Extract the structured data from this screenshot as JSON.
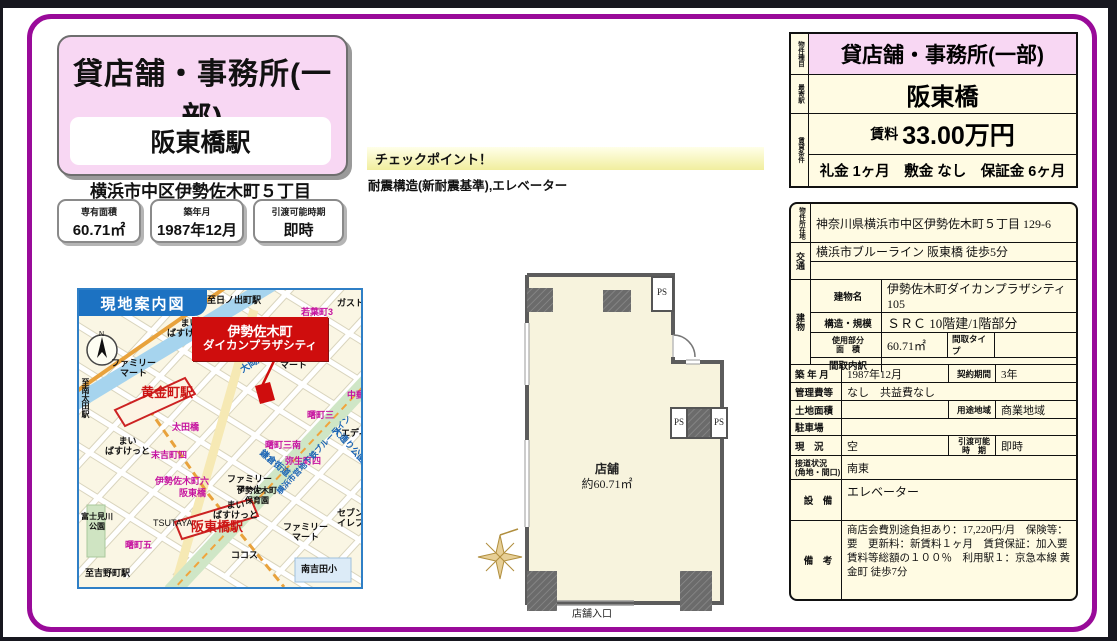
{
  "left": {
    "property_type": "貸店舗・事務所(一部)",
    "station": "阪東橋駅",
    "address": "横浜市中区伊勢佐木町５丁目",
    "stats": [
      {
        "label": "専有面積",
        "value": "60.71㎡"
      },
      {
        "label": "築年月",
        "value": "1987年12月"
      },
      {
        "label": "引渡可能時期",
        "value": "即時"
      }
    ]
  },
  "checkpoint": {
    "title": "チェックポイント！",
    "text": "耐震構造(新耐震基準),エレベーター"
  },
  "summary": {
    "type_label": "物件種目",
    "type_value": "貸店舗・事務所(一部)",
    "station_label": "最寄駅",
    "station_value": "阪東橋",
    "terms_label": "賃貸条件",
    "rent_label": "賃料",
    "rent_value": "33.00万円",
    "terms_value": "礼金 1ヶ月　敷金 なし　保証金 6ヶ月"
  },
  "details": {
    "location_label": "物件所在地",
    "location_value": "神奈川県横浜市中区伊勢佐木町５丁目 129-6",
    "access_label": "交通",
    "access_value": "横浜市ブルーライン 阪東橋 徒歩5分",
    "building_label": "建物",
    "building_name_label": "建物名",
    "building_name_value": "伊勢佐木町ダイカンプラザシティ　105",
    "structure_label": "構造・規模",
    "structure_value": "ＳＲＣ 10階建/1階部分",
    "used_area_label": "使用部分\n面　積",
    "used_area_value": "60.71㎡",
    "layout_type_label": "間取タイプ",
    "layout_type_value": "",
    "layout_detail_label": "間取内訳",
    "layout_detail_value": "",
    "built_label": "築 年 月",
    "built_value": "1987年12月",
    "contract_label": "契約期間",
    "contract_value": "3年",
    "mgmt_label": "管理費等",
    "mgmt_value": "なし　共益費なし",
    "land_label": "土地面積",
    "land_value": "",
    "zoning_label": "用途地域",
    "zoning_value": "商業地域",
    "parking_label": "駐車場",
    "parking_value": "",
    "status_label": "現　況",
    "status_value": "空",
    "handover_label": "引渡可能\n時　期",
    "handover_value": "即時",
    "road_label": "接道状況\n(角地・間口)",
    "road_value": "南東",
    "equipment_label": "設　備",
    "equipment_value": "エレベーター",
    "remarks_label": "備　考",
    "remarks_value": "商店会費別途負担あり：17,220円/月　保険等：要　更新料：新賃料１ヶ月　賃貸保証：加入要 賃料等総額の１００％　利用駅１：京急本線 黄金町 徒歩7分"
  },
  "floorplan": {
    "room_name": "店舗",
    "room_area": "約60.71㎡",
    "entrance_label": "店舗入口",
    "ps_label": "PS"
  },
  "map": {
    "title": "現地案内図",
    "callout_line1": "伊勢佐木町",
    "callout_line2": "ダイカンプラザシティ",
    "labels": {
      "to_hinodecho": "至日ノ出町駅",
      "to_minamiota": "至南太田駅",
      "to_yoshinocho": "至吉野町駅",
      "wakabacho3": "若葉町3",
      "gusto": "ガスト",
      "maibasuketto": "まい\nばすけっと",
      "familymart": "ファミリー\nマート",
      "koganecho_sta": "黄金町駅",
      "keikyu_line": "京急本線",
      "ookagawa": "大岡川",
      "ota_bashi": "太田橋",
      "sueyoshicho4": "末吉町四",
      "nakayubin": "中郵",
      "edion": "エディオン",
      "akebonocho3": "曙町三",
      "akebonocho3s": "曙町三南",
      "isezakicho6": "伊勢佐木町六",
      "kamakura_kaido": "鎌倉街道",
      "yayoicho4": "弥生町四",
      "odori_park": "大通り公園",
      "subway_line": "横浜市営地下鉄ブルーライン",
      "hoikuen": "伊勢佐木町\n保育園",
      "bandobashi": "阪東橋",
      "tsutaya": "TSUTAYA",
      "fujimigawa_park": "富士見川\n公園",
      "akebonocho5": "曙町五",
      "bandobashi_sta": "阪東橋駅",
      "cocos": "ココス",
      "seven": "セブン\nイレブン",
      "minamiyoshida": "南吉田小"
    }
  }
}
